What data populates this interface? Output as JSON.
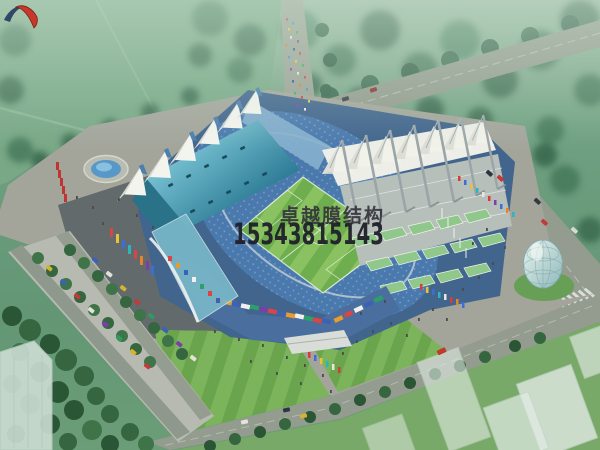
{
  "watermark": {
    "brand_name": "卓越膜结构",
    "phone_number": "15343815143",
    "logo": "brush-swoosh-logo",
    "colors": {
      "brand_text": "#34333b",
      "phone_text": "#1f1f29",
      "logo_red": "#c5392b",
      "logo_blue": "#263a5e"
    }
  },
  "scene": {
    "subject": "Aerial architectural rendering of a stadium with white tensile membrane roofs",
    "elements": [
      "hazy forest belt and open lawns",
      "perimeter roads with cars and a pedestrian crowd",
      "circular fountain plaza",
      "teal west-stand roof with six white membrane peaks",
      "striped football pitch with white markings",
      "east stand with seven mast-supported membrane cones",
      "green terraced entrance ramps",
      "rows of colorful flags",
      "glass egg-shaped pavilion on a green mound",
      "tree-lined parking avenue with parked cars",
      "translucent white city blocks",
      "stadium shadow cast on the plaza"
    ],
    "palette": {
      "forest": "#4e8465",
      "field": "#78a886",
      "road": "#939c8e",
      "plaza": "#a3a59b",
      "shadow": "#4f5a5e",
      "pitch_light": "#8ac262",
      "pitch_dark": "#6fae4e",
      "roof_teal": "#3f93ab",
      "membrane": "#f2f3ec",
      "seating": "#4a79ad",
      "dome_glass": "#aecfc9",
      "terrace_green": "#90c78b",
      "ad_band": "#d84545"
    }
  }
}
